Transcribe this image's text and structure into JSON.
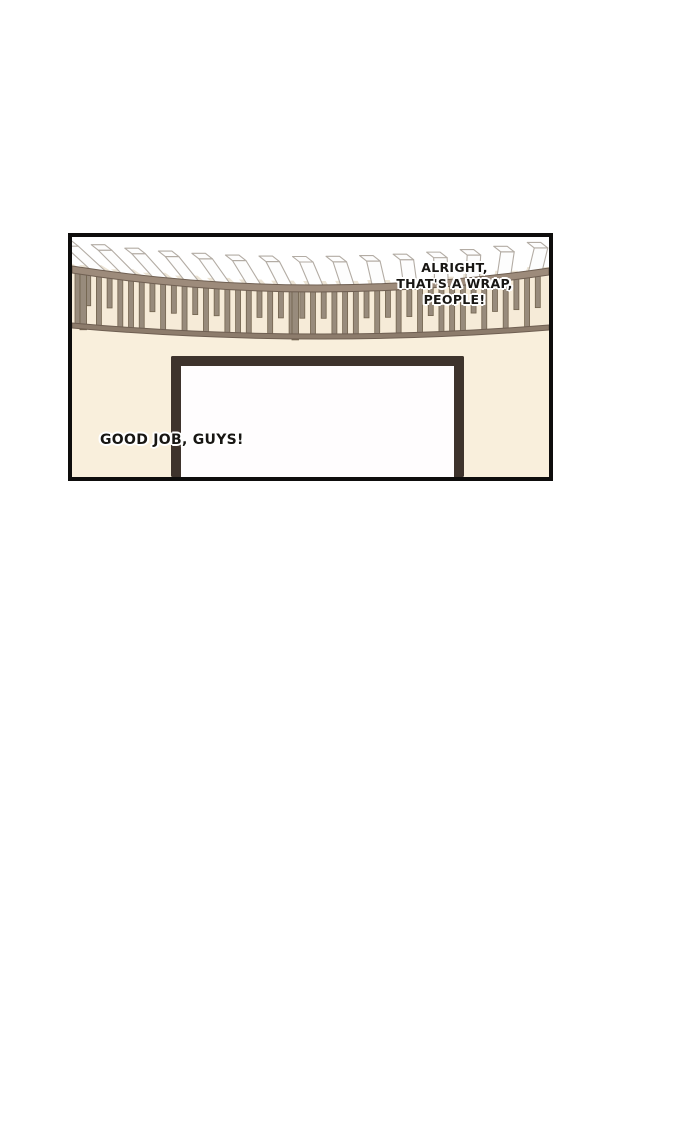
{
  "page": {
    "background": "#ffffff"
  },
  "panel": {
    "border_color": "#0e0d0c",
    "art": {
      "colors": {
        "sky": "#ffffff",
        "wall": "#f9efdc",
        "railing_bg": "#f6ebd8",
        "under_box_shadow": "#ece4d5",
        "rail_band_top": "#9d8b7b",
        "rail_band_bottom": "#8d7c6c",
        "rail_outline": "#6f5f52",
        "slat_fill": "#988b7c",
        "slat_outline": "#73644f",
        "box_fill": "#fdfdfd",
        "box_outline": "#b3aca4",
        "door_frame": "#3e332c",
        "door_interior": "#fffdfe"
      },
      "top_rail": {
        "left_y": 29,
        "mid_y": 48,
        "right_y": 31,
        "thickness": 7
      },
      "bottom_rail": {
        "left_y": 86,
        "mid_y": 97,
        "right_y": 88,
        "thickness": 5
      },
      "slats": {
        "count": 44,
        "width": 5,
        "short_ratio": 0.62
      },
      "boxes": {
        "count": 17,
        "width": 13.5,
        "height": 26,
        "left_skew": -30,
        "right_skew": 8
      },
      "posts": [
        8,
        220
      ],
      "door": {
        "x": 99,
        "y": 119,
        "width": 293,
        "frame": 10
      }
    }
  },
  "dialogue": {
    "wrap": {
      "lines": [
        "ALRIGHT,",
        "THAT'S A WRAP,",
        "PEOPLE!"
      ]
    },
    "goodjob": {
      "text": "GOOD JOB, GUYS!"
    }
  }
}
